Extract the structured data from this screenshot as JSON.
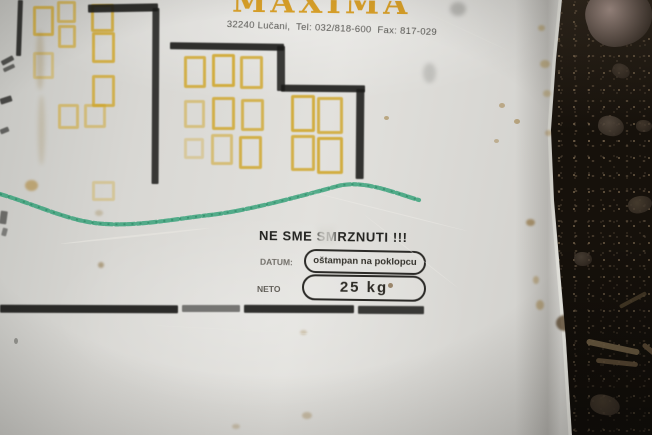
{
  "scene": {
    "label_text": {
      "brand": "MAXIMA",
      "address": "32240 Lučani,  Tel: 032/818-600  Fax: 817-029",
      "warning": "NE SME SMRZNUTI !!!",
      "datum_label": "DATUM:",
      "datum_value": "oštampan na poklopcu",
      "neto_label": "NETO",
      "neto_value": "25 kg"
    },
    "colors": {
      "plastic": "#dcdbd7",
      "ink_black": "#1c1c1a",
      "window_yellow": "#cfa21c",
      "brand_orange": "#d6991a",
      "marker_green": "#2f9f76",
      "gravel_dark": "#16110b",
      "stone_gray": "#9a857d",
      "stain_brown": "#9a7a2e"
    },
    "graphic": {
      "windows": [
        {
          "x": 33,
          "y": 6,
          "w": 15,
          "h": 24,
          "o": 0.7
        },
        {
          "x": 57,
          "y": 1,
          "w": 13,
          "h": 16,
          "o": 0.6
        },
        {
          "x": 91,
          "y": 4,
          "w": 17,
          "h": 22,
          "o": 0.75
        },
        {
          "x": 58,
          "y": 25,
          "w": 12,
          "h": 17,
          "o": 0.6
        },
        {
          "x": 92,
          "y": 32,
          "w": 17,
          "h": 25,
          "o": 0.75
        },
        {
          "x": 33,
          "y": 52,
          "w": 15,
          "h": 21,
          "o": 0.4
        },
        {
          "x": 92,
          "y": 75,
          "w": 17,
          "h": 26,
          "o": 0.7
        },
        {
          "x": 58,
          "y": 104,
          "w": 15,
          "h": 19,
          "o": 0.5
        },
        {
          "x": 84,
          "y": 104,
          "w": 16,
          "h": 18,
          "o": 0.45
        },
        {
          "x": 92,
          "y": 181,
          "w": 17,
          "h": 14,
          "o": 0.3
        },
        {
          "x": 184,
          "y": 56,
          "w": 16,
          "h": 26,
          "o": 0.75
        },
        {
          "x": 212,
          "y": 54,
          "w": 17,
          "h": 27,
          "o": 0.8
        },
        {
          "x": 240,
          "y": 56,
          "w": 17,
          "h": 27,
          "o": 0.75
        },
        {
          "x": 184,
          "y": 100,
          "w": 15,
          "h": 22,
          "o": 0.45
        },
        {
          "x": 212,
          "y": 97,
          "w": 17,
          "h": 27,
          "o": 0.75
        },
        {
          "x": 241,
          "y": 99,
          "w": 17,
          "h": 26,
          "o": 0.7
        },
        {
          "x": 184,
          "y": 138,
          "w": 14,
          "h": 15,
          "o": 0.3
        },
        {
          "x": 211,
          "y": 134,
          "w": 16,
          "h": 25,
          "o": 0.5
        },
        {
          "x": 239,
          "y": 136,
          "w": 17,
          "h": 27,
          "o": 0.75
        },
        {
          "x": 291,
          "y": 95,
          "w": 18,
          "h": 31,
          "o": 0.8
        },
        {
          "x": 317,
          "y": 97,
          "w": 20,
          "h": 31,
          "o": 0.75
        },
        {
          "x": 291,
          "y": 135,
          "w": 18,
          "h": 30,
          "o": 0.75
        },
        {
          "x": 317,
          "y": 137,
          "w": 20,
          "h": 31,
          "o": 0.8
        }
      ],
      "lines": [
        {
          "x": 17,
          "y": 0,
          "w": 5,
          "h": 56,
          "r": 2,
          "o": 0.85
        },
        {
          "x": 1,
          "y": 58,
          "w": 13,
          "h": 5,
          "r": -28,
          "o": 0.7
        },
        {
          "x": 3,
          "y": 66,
          "w": 12,
          "h": 4,
          "r": -25,
          "o": 0.6
        },
        {
          "x": 88,
          "y": 4,
          "w": 70,
          "h": 8,
          "r": -1,
          "o": 0.9
        },
        {
          "x": 152,
          "y": 8,
          "w": 7,
          "h": 176,
          "r": 0.3,
          "o": 0.85
        },
        {
          "x": 170,
          "y": 43,
          "w": 114,
          "h": 7,
          "r": 0.8,
          "o": 0.9
        },
        {
          "x": 277,
          "y": 46,
          "w": 8,
          "h": 45,
          "r": 0,
          "o": 0.85
        },
        {
          "x": 281,
          "y": 85,
          "w": 84,
          "h": 7,
          "r": 0.5,
          "o": 0.9
        },
        {
          "x": 356,
          "y": 89,
          "w": 8,
          "h": 90,
          "r": 0.5,
          "o": 0.88
        },
        {
          "x": 0,
          "y": 305,
          "w": 178,
          "h": 8,
          "r": 0.2,
          "o": 0.92
        },
        {
          "x": 182,
          "y": 305,
          "w": 58,
          "h": 7,
          "r": 0,
          "o": 0.55
        },
        {
          "x": 244,
          "y": 305,
          "w": 110,
          "h": 8,
          "r": 0.2,
          "o": 0.9
        },
        {
          "x": 358,
          "y": 306,
          "w": 66,
          "h": 8,
          "r": 0.3,
          "o": 0.85
        },
        {
          "x": 0,
          "y": 97,
          "w": 12,
          "h": 6,
          "r": -18,
          "o": 0.75
        },
        {
          "x": 0,
          "y": 128,
          "w": 9,
          "h": 5,
          "r": -22,
          "o": 0.6
        },
        {
          "x": 0,
          "y": 211,
          "w": 7,
          "h": 13,
          "r": 8,
          "o": 0.55
        },
        {
          "x": 2,
          "y": 228,
          "w": 5,
          "h": 8,
          "r": 15,
          "o": 0.45
        }
      ],
      "stains": [
        {
          "x": 36,
          "y": 30,
          "w": 8,
          "h": 60,
          "c": "#8a6a24",
          "o": 0.22,
          "b": 2
        },
        {
          "x": 38,
          "y": 95,
          "w": 7,
          "h": 70,
          "c": "#8a6a24",
          "o": 0.18,
          "b": 2
        },
        {
          "x": 25,
          "y": 180,
          "w": 13,
          "h": 11,
          "c": "#a87a20",
          "o": 0.5,
          "b": 1
        },
        {
          "x": 98,
          "y": 262,
          "w": 6,
          "h": 6,
          "c": "#7a5a20",
          "o": 0.45,
          "b": 1
        },
        {
          "x": 450,
          "y": 2,
          "w": 16,
          "h": 14,
          "c": "#6a6a66",
          "o": 0.35,
          "b": 2
        },
        {
          "x": 423,
          "y": 63,
          "w": 13,
          "h": 20,
          "c": "#8a8a86",
          "o": 0.35,
          "b": 2
        },
        {
          "x": 384,
          "y": 116,
          "w": 5,
          "h": 4,
          "c": "#96712c",
          "o": 0.5,
          "b": 0
        },
        {
          "x": 499,
          "y": 103,
          "w": 6,
          "h": 5,
          "c": "#96712c",
          "o": 0.45,
          "b": 0
        },
        {
          "x": 514,
          "y": 119,
          "w": 6,
          "h": 5,
          "c": "#96712c",
          "o": 0.5,
          "b": 0
        },
        {
          "x": 494,
          "y": 139,
          "w": 5,
          "h": 4,
          "c": "#96712c",
          "o": 0.4,
          "b": 0
        },
        {
          "x": 526,
          "y": 219,
          "w": 9,
          "h": 7,
          "c": "#8a6220",
          "o": 0.55,
          "b": 1
        },
        {
          "x": 533,
          "y": 276,
          "w": 6,
          "h": 8,
          "c": "#a07a30",
          "o": 0.4,
          "b": 1
        },
        {
          "x": 536,
          "y": 300,
          "w": 8,
          "h": 10,
          "c": "#a07a30",
          "o": 0.45,
          "b": 1
        },
        {
          "x": 540,
          "y": 60,
          "w": 10,
          "h": 8,
          "c": "#b08a30",
          "o": 0.4,
          "b": 1
        },
        {
          "x": 543,
          "y": 90,
          "w": 8,
          "h": 7,
          "c": "#b08a30",
          "o": 0.35,
          "b": 1
        },
        {
          "x": 538,
          "y": 25,
          "w": 7,
          "h": 6,
          "c": "#b08a30",
          "o": 0.4,
          "b": 1
        },
        {
          "x": 545,
          "y": 130,
          "w": 7,
          "h": 6,
          "c": "#a87a28",
          "o": 0.35,
          "b": 1
        },
        {
          "x": 556,
          "y": 315,
          "w": 18,
          "h": 16,
          "c": "#4a3418",
          "o": 0.7,
          "b": 1
        },
        {
          "x": 388,
          "y": 283,
          "w": 5,
          "h": 5,
          "c": "#6a4a20",
          "o": 0.6,
          "b": 0
        },
        {
          "x": 300,
          "y": 330,
          "w": 7,
          "h": 5,
          "c": "#9a7a40",
          "o": 0.3,
          "b": 1
        },
        {
          "x": 302,
          "y": 412,
          "w": 10,
          "h": 7,
          "c": "#9a7a40",
          "o": 0.35,
          "b": 1
        },
        {
          "x": 232,
          "y": 424,
          "w": 8,
          "h": 5,
          "c": "#9a7a40",
          "o": 0.3,
          "b": 1
        },
        {
          "x": 14,
          "y": 338,
          "w": 4,
          "h": 6,
          "c": "#555550",
          "o": 0.5,
          "b": 0
        },
        {
          "x": 95,
          "y": 210,
          "w": 8,
          "h": 6,
          "c": "#8a6a24",
          "o": 0.25,
          "b": 1
        },
        {
          "x": 60,
          "y": 235,
          "w": 150,
          "h": 2,
          "c": "#eceae4",
          "o": 0.5,
          "b": 0,
          "r": -6
        },
        {
          "x": 300,
          "y": 210,
          "w": 170,
          "h": 1,
          "c": "#efeee8",
          "o": 0.45,
          "b": 0,
          "r": 14
        },
        {
          "x": 350,
          "y": 250,
          "w": 120,
          "h": 1,
          "c": "#efeee8",
          "o": 0.4,
          "b": 0,
          "r": 38
        },
        {
          "x": 150,
          "y": 330,
          "w": 200,
          "h": 1,
          "c": "#e8e7e1",
          "o": 0.35,
          "b": 0,
          "r": 3
        },
        {
          "x": 420,
          "y": 30,
          "w": 90,
          "h": 1,
          "c": "#e8e7e1",
          "o": 0.3,
          "b": 0,
          "r": 25
        }
      ],
      "stones": [
        {
          "x": 586,
          "y": -14,
          "w": 66,
          "h": 60,
          "c": "#a8938b",
          "r": -18,
          "o": 1
        },
        {
          "x": 612,
          "y": 64,
          "w": 18,
          "h": 14,
          "c": "#4e4236",
          "r": 20,
          "o": 0.8
        },
        {
          "x": 598,
          "y": 116,
          "w": 26,
          "h": 20,
          "c": "#5c5044",
          "r": 10,
          "o": 0.85
        },
        {
          "x": 636,
          "y": 120,
          "w": 16,
          "h": 12,
          "c": "#56483a",
          "r": 0,
          "o": 0.7
        },
        {
          "x": 628,
          "y": 196,
          "w": 24,
          "h": 17,
          "c": "#544838",
          "r": -15,
          "o": 0.8
        },
        {
          "x": 574,
          "y": 252,
          "w": 18,
          "h": 14,
          "c": "#5a4e42",
          "r": 0,
          "o": 0.7
        },
        {
          "x": 590,
          "y": 395,
          "w": 30,
          "h": 20,
          "c": "#4a3e30",
          "r": 12,
          "o": 0.8
        }
      ],
      "twigs": [
        {
          "x": 586,
          "y": 344,
          "w": 54,
          "h": 6,
          "c": "#6d5c42",
          "r": 12,
          "o": 0.9
        },
        {
          "x": 596,
          "y": 360,
          "w": 42,
          "h": 5,
          "c": "#5d4c36",
          "r": 6,
          "o": 0.85
        },
        {
          "x": 618,
          "y": 298,
          "w": 30,
          "h": 4,
          "c": "#54462f",
          "r": -28,
          "o": 0.7
        },
        {
          "x": 640,
          "y": 350,
          "w": 26,
          "h": 5,
          "c": "#66543c",
          "r": 40,
          "o": 0.8
        }
      ]
    }
  }
}
